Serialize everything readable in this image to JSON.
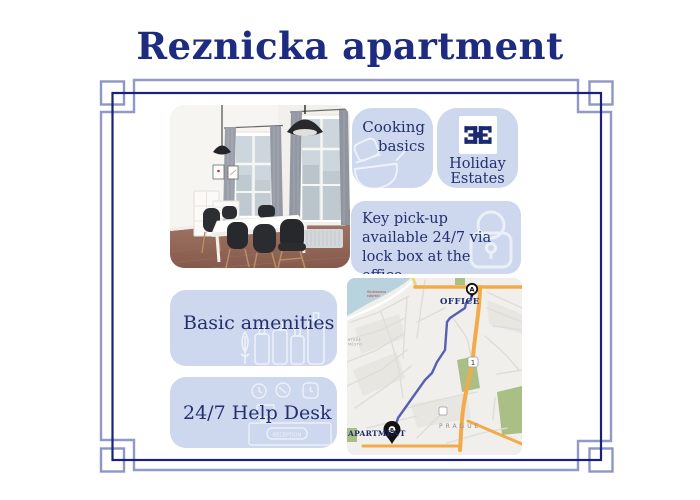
{
  "title": "Reznicka apartment",
  "cards": {
    "cooking": {
      "label": "Cooking basics"
    },
    "holiday": {
      "line1": "Holiday",
      "line2": "Estates"
    },
    "key": {
      "text": "Key pick-up available 24/7 via lock box at the office."
    },
    "amenities": {
      "label": "Basic amenities"
    },
    "helpdesk": {
      "label": "24/7 Help Desk",
      "sign": "RECEPTION"
    }
  },
  "map": {
    "office_label": "OFFICE",
    "office_marker": "A",
    "apartment_label": "APARTMENT",
    "apartment_marker": "B",
    "city_label": "PRAGUE",
    "road_badge": "1",
    "street_line1": "Smetanovo",
    "street_line2": "nábřeží",
    "district_line1": "STARÉ",
    "district_line2": "MĚSTO"
  },
  "colors": {
    "accent_navy": "#1d2b80",
    "card_bg": "#cdd7ed",
    "frame_light": "#9199c7",
    "frame_dark": "#1b2178",
    "route_blue": "#5560b4",
    "road_orange": "#f3ab4a",
    "water_blue": "#b9d3de",
    "park_green": "#a9bf85"
  }
}
